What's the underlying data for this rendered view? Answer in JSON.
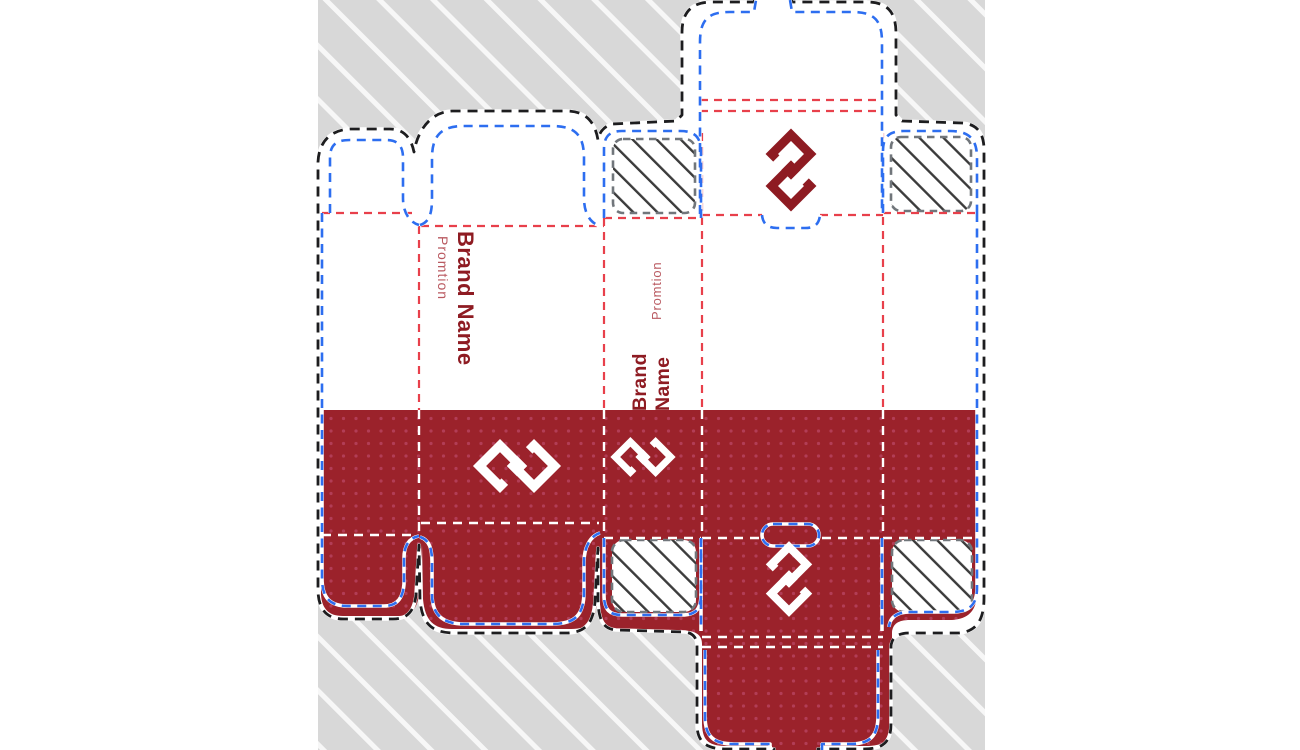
{
  "artboard": {
    "background": "#d8d8d8",
    "stripe": "#ffffff"
  },
  "dieline": {
    "front_panel": {
      "brand_name": "Brand Name",
      "promotion": "Promtion"
    },
    "side_panel": {
      "brand_word1": "Brand",
      "brand_word2": "Name",
      "promotion": "Promtion"
    }
  },
  "icons": {
    "logo": "interlocked-squares-brand-logo"
  },
  "colors": {
    "panel_red": "#9b222b",
    "dot_pink": "#c4537a",
    "brand_dark_red": "#8e1b22",
    "promo_red": "#b95960",
    "cut_black": "#1d1d1f",
    "crease_red": "#e8404b",
    "bleed_blue": "#2d6ef0",
    "glue_gray": "#71767b",
    "hatch_dark": "#3b3b3b",
    "fold_white": "#ffffff",
    "paper_white": "#ffffff"
  }
}
